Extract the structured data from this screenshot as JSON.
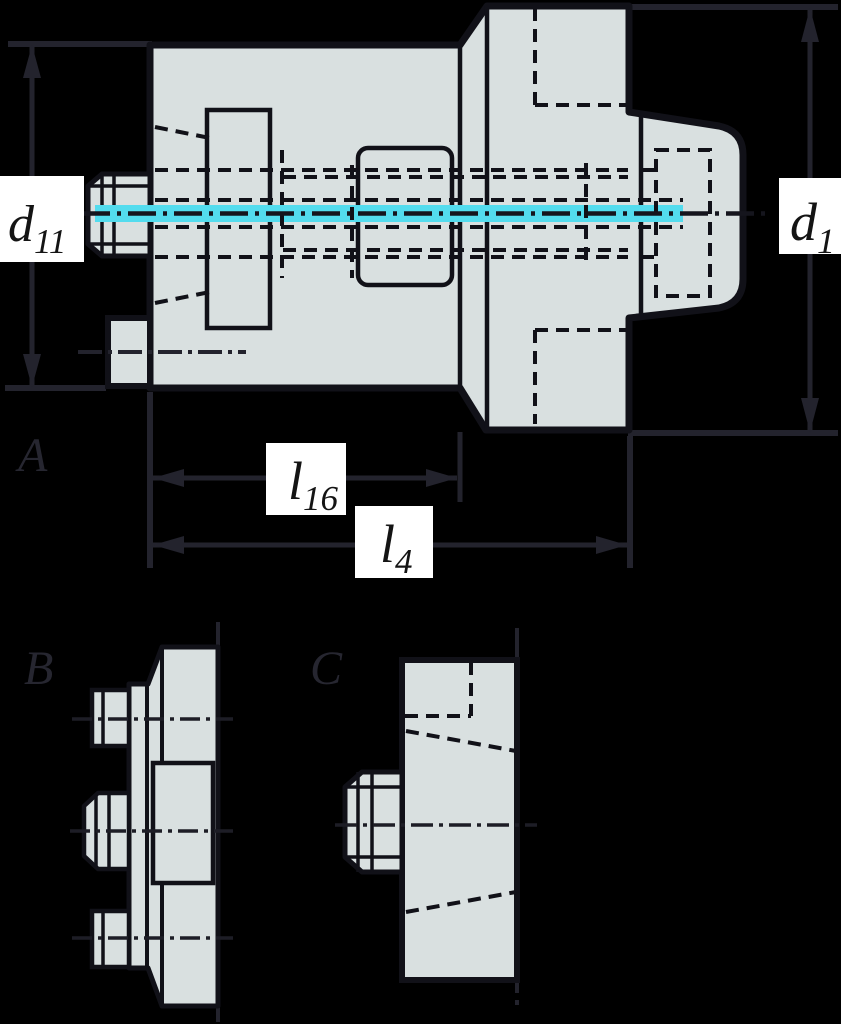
{
  "colors": {
    "background": "#000000",
    "body_fill": "#d9e0e0",
    "outline": "#111118",
    "dimension_lines": "#23232d",
    "centerline_cyan": "#53dcee",
    "label_box": "#ffffff",
    "label_text": "#141414"
  },
  "view_labels": {
    "a": "A",
    "b": "B",
    "c": "C"
  },
  "dims": {
    "d11": {
      "base": "d",
      "sub": "11"
    },
    "d1": {
      "base": "d",
      "sub": "1"
    },
    "l16": {
      "base": "l",
      "sub": "16"
    },
    "l4": {
      "base": "l",
      "sub": "4"
    }
  }
}
